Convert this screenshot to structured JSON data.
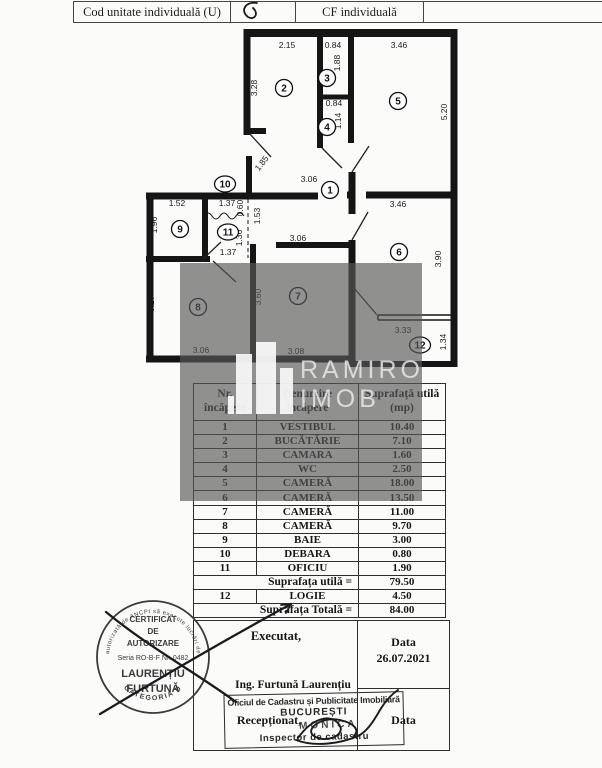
{
  "header_bar": {
    "cod_label": "Cod unitate individuală (U)",
    "cf_label": "CF individuală"
  },
  "plan": {
    "rooms": [
      "1",
      "2",
      "3",
      "4",
      "5",
      "6",
      "7",
      "8",
      "9",
      "10",
      "11",
      "12"
    ],
    "dims": [
      "2.15",
      "0.84",
      "3.46",
      "3.28",
      "1.88",
      "0.84",
      "1.14",
      "5.20",
      "1.85",
      "3.06",
      "1.52",
      "1.37",
      "0.60",
      "1.53",
      "3.46",
      "1.96",
      "1.36",
      "1.37",
      "3.06",
      "3.90",
      "3.17",
      "3.60",
      "3.33",
      "1.34",
      "3.06",
      "3.08"
    ]
  },
  "watermark": {
    "line1": "RAMIRO",
    "line2": "IMOB"
  },
  "table": {
    "header": {
      "nr1": "Nr.",
      "nr2": "încăpere",
      "den1": "Denumire",
      "den2": "încăpere",
      "sup1": "Suprafață utilă",
      "sup2": "(mp)"
    },
    "rows": [
      {
        "nr": "1",
        "den": "VESTIBUL",
        "mp": "10.40"
      },
      {
        "nr": "2",
        "den": "BUCĂTĂRIE",
        "mp": "7.10"
      },
      {
        "nr": "3",
        "den": "CAMARA",
        "mp": "1.60"
      },
      {
        "nr": "4",
        "den": "WC",
        "mp": "2.50"
      },
      {
        "nr": "5",
        "den": "CAMERĂ",
        "mp": "18.00"
      },
      {
        "nr": "6",
        "den": "CAMERĂ",
        "mp": "13.50"
      },
      {
        "nr": "7",
        "den": "CAMERĂ",
        "mp": "11.00"
      },
      {
        "nr": "8",
        "den": "CAMERĂ",
        "mp": "9.70"
      },
      {
        "nr": "9",
        "den": "BAIE",
        "mp": "3.00"
      },
      {
        "nr": "10",
        "den": "DEBARA",
        "mp": "0.80"
      },
      {
        "nr": "11",
        "den": "OFICIU",
        "mp": "1.90"
      }
    ],
    "subtotal": {
      "label": "Suprafața utilă =",
      "value": "79.50"
    },
    "logie": {
      "nr": "12",
      "den": "LOGIE",
      "mp": "4.50"
    },
    "total": {
      "label": "Suprafața Totală =",
      "value": "84.00"
    }
  },
  "footer": {
    "executat": "Executat,",
    "engineer": "Ing. Furtună Laurențiu",
    "data_label": "Data",
    "data_value": "26.07.2021",
    "receptionat": "Recepționat,",
    "data_label_2": "Data",
    "ocpi": {
      "line1": "Oficiul de Cadastru și Publicitate Imobiliară",
      "line2": "BUCUREȘTI",
      "name": "MONICA",
      "line3": "Inspector de cadastru"
    }
  },
  "round_stamp": {
    "arc_top": "autorizată de ANCPI să execute lucrări de",
    "l1": "CERTIFICAT",
    "l2": "DE",
    "l3": "AUTORIZARE",
    "l4": "Seria RO-B-F Nr. 0482",
    "l5": "LAURENȚIU",
    "l6": "FURTUNĂ",
    "arc_bottom": "CATEGORIA D"
  }
}
